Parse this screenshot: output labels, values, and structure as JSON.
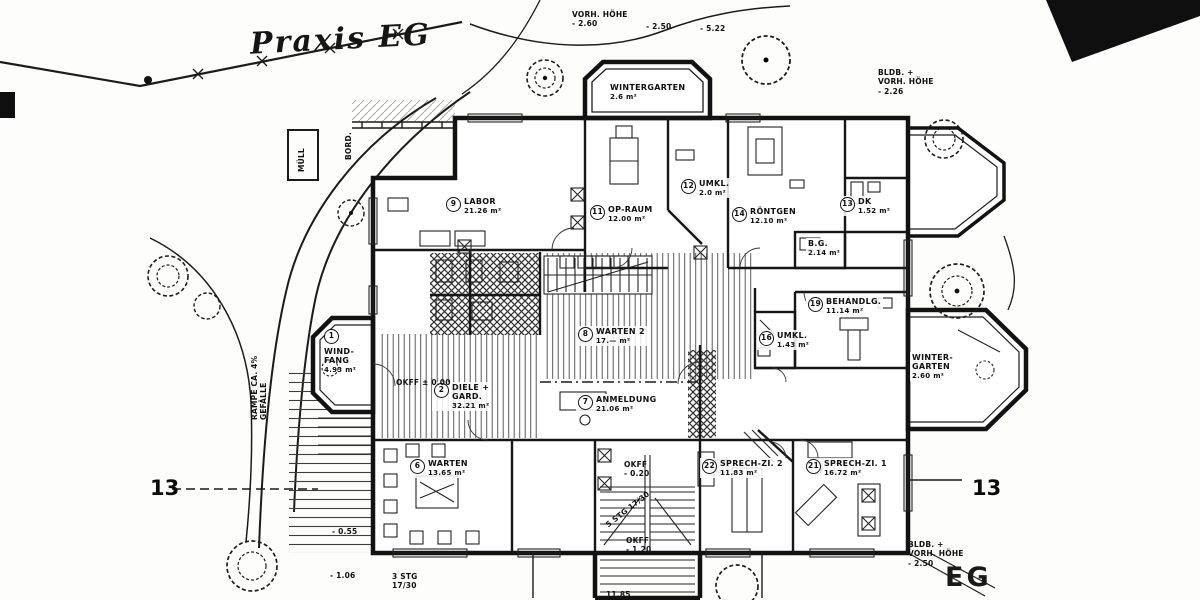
{
  "title": "Praxis EG",
  "markers": {
    "section_left": "13",
    "section_right": "13",
    "eg": "EG"
  },
  "plan": {
    "rooms": [
      {
        "num": "1",
        "name": "WIND-\nFANG",
        "area": "4.93 m²",
        "x": 322,
        "y": 328,
        "stack": true
      },
      {
        "num": "2",
        "name": "DIELE +\nGARD.",
        "area": "32.21 m²",
        "x": 432,
        "y": 382
      },
      {
        "num": "6",
        "name": "WARTEN",
        "area": "13.65 m²",
        "x": 408,
        "y": 458
      },
      {
        "num": "7",
        "name": "ANMELDUNG",
        "area": "21.06 m²",
        "x": 576,
        "y": 394
      },
      {
        "num": "8",
        "name": "WARTEN 2",
        "area": "17.— m²",
        "x": 576,
        "y": 326
      },
      {
        "num": "9",
        "name": "LABOR",
        "area": "21.26 m²",
        "x": 444,
        "y": 196
      },
      {
        "num": "11",
        "name": "OP-RAUM",
        "area": "12.00 m²",
        "x": 588,
        "y": 204
      },
      {
        "num": "12",
        "name": "UMKL.",
        "area": "2.0 m²",
        "x": 679,
        "y": 178
      },
      {
        "num": "13",
        "name": "DK",
        "area": "1.52 m²",
        "x": 838,
        "y": 196
      },
      {
        "num": "14",
        "name": "RÖNTGEN",
        "area": "12.10 m²",
        "x": 730,
        "y": 206
      },
      {
        "num": "",
        "name": "B.G.",
        "area": "2.14 m²",
        "x": 806,
        "y": 238
      },
      {
        "num": "16",
        "name": "UMKL.",
        "area": "1.43 m²",
        "x": 757,
        "y": 330
      },
      {
        "num": "19",
        "name": "BEHANDLG.",
        "area": "11.14 m²",
        "x": 806,
        "y": 296
      },
      {
        "num": "22",
        "name": "SPRECH-ZI. 2",
        "area": "11.83 m²",
        "x": 700,
        "y": 458
      },
      {
        "num": "21",
        "name": "SPRECH-ZI. 1",
        "area": "16.72 m²",
        "x": 804,
        "y": 458
      },
      {
        "num": "",
        "name": "WINTERGARTEN",
        "area": "2.6 m²",
        "x": 608,
        "y": 82
      },
      {
        "num": "",
        "name": "WINTER-\nGARTEN",
        "area": "2.60 m²",
        "x": 910,
        "y": 352
      }
    ],
    "annotations": [
      {
        "text": "VORH. HÖHE\n- 2.60",
        "x": 572,
        "y": 10,
        "rot": 0
      },
      {
        "text": "- 2.50",
        "x": 646,
        "y": 22,
        "rot": 0
      },
      {
        "text": "- 5.22",
        "x": 700,
        "y": 24,
        "rot": 0
      },
      {
        "text": "BLDB. +\nVORH. HÖHE\n- 2.26",
        "x": 878,
        "y": 68,
        "rot": 0
      },
      {
        "text": "BLDB. +\nVORH. HÖHE\n- 2.50",
        "x": 908,
        "y": 540,
        "rot": 0
      },
      {
        "text": "MÜLL",
        "x": 297,
        "y": 172,
        "rot": -90
      },
      {
        "text": "BORD.",
        "x": 344,
        "y": 160,
        "rot": -90
      },
      {
        "text": "RAMPE  CA. 4%\nGEFÄLLE",
        "x": 250,
        "y": 420,
        "rot": -90
      },
      {
        "text": "OKFF ± 0.00",
        "x": 396,
        "y": 378,
        "rot": 0
      },
      {
        "text": "OKFF\n- 0.20",
        "x": 624,
        "y": 460,
        "rot": 0
      },
      {
        "text": "OKFF\n- 1.20",
        "x": 626,
        "y": 536,
        "rot": 0
      },
      {
        "text": "- 0.55",
        "x": 332,
        "y": 527,
        "rot": 0
      },
      {
        "text": "- 1.06",
        "x": 330,
        "y": 571,
        "rot": 0
      },
      {
        "text": "3 STG\n17/30",
        "x": 392,
        "y": 572,
        "rot": 0
      },
      {
        "text": "5 STG 17/30",
        "x": 604,
        "y": 522,
        "rot": -38
      },
      {
        "text": "11.85",
        "x": 606,
        "y": 590,
        "rot": 0
      }
    ]
  }
}
